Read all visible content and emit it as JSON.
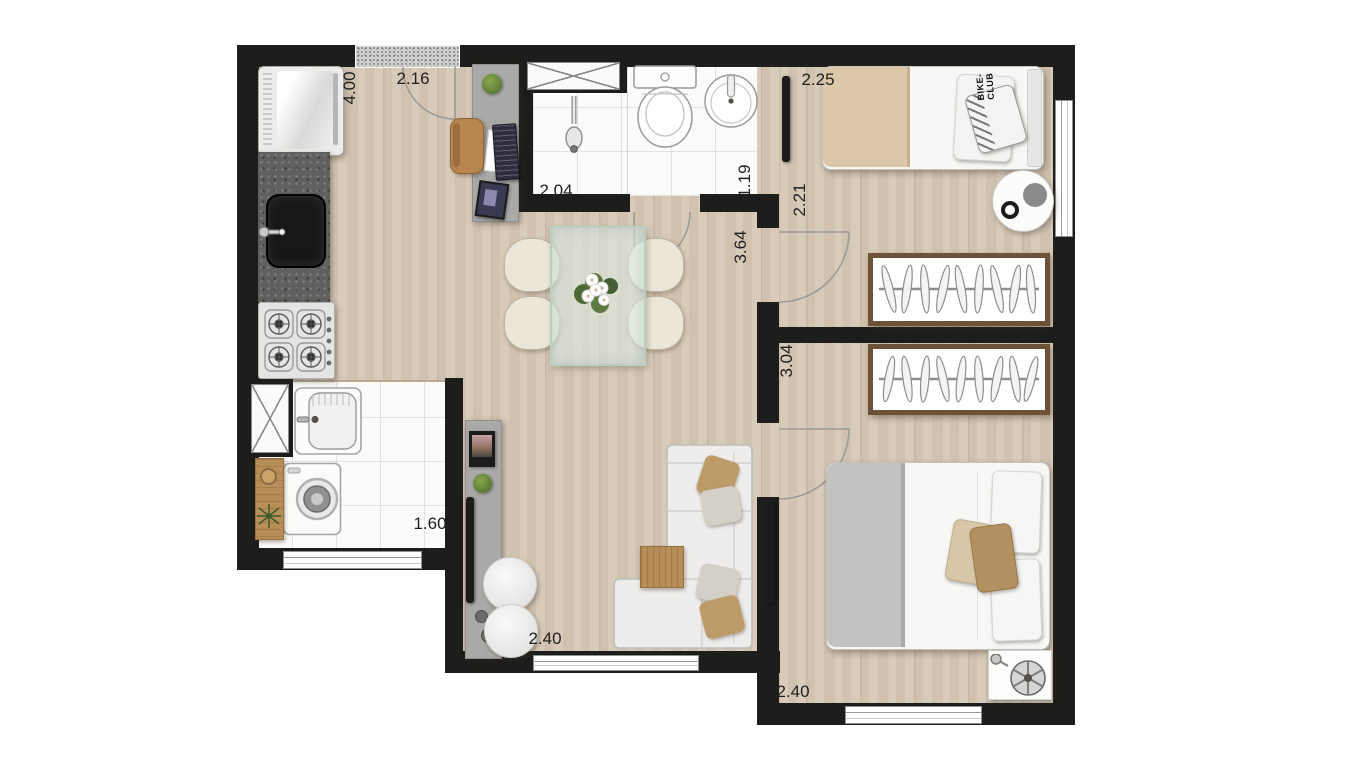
{
  "dimensions": {
    "kitchen_depth": "4.00",
    "kitchen_width": "2.16",
    "bathroom_width": "2.04",
    "bathroom_depth": "1.19",
    "bedroom1_width": "2.25",
    "bedroom1_depth": "2.21",
    "hall_depth": "3.64",
    "bedroom2_depth": "3.04",
    "laundry_width": "1.60",
    "living_width": "2.40",
    "bedroom2_width": "2.40"
  },
  "decor": {
    "pillow_print": "BIKE-CLUB"
  },
  "colors": {
    "wall": "#1d1d1b",
    "wood_floor": "#d6c7b4",
    "tile_floor": "#fbfbfa",
    "counter_granite": "#60605e",
    "wardrobe_frame": "#6e5238",
    "blanket_beige": "#dcc8a9",
    "blanket_gray": "#c2c2c0",
    "pillow_tan": "#bc9b69",
    "wood_accent": "#b88e58",
    "cabinet_gray": "#a9a9a7",
    "plant_green": "#5c7a3c"
  }
}
